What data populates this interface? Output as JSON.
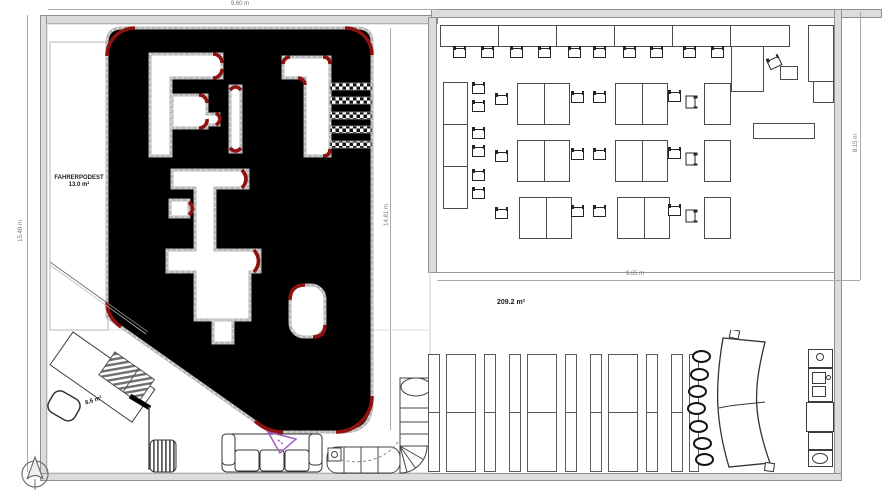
{
  "dimensions": {
    "hall_width": "9.60 m",
    "hall_height": "15.48 m",
    "track_height": "14.81 m",
    "seating_height": "8.15 m",
    "seating_width": "9.65 m"
  },
  "areas": {
    "fahrerpodest_name": "FAHRERPODEST",
    "fahrerpodest_area": "13.0 m²",
    "main_hall_area": "209.2 m²",
    "reception_area": "8.6 m²"
  }
}
